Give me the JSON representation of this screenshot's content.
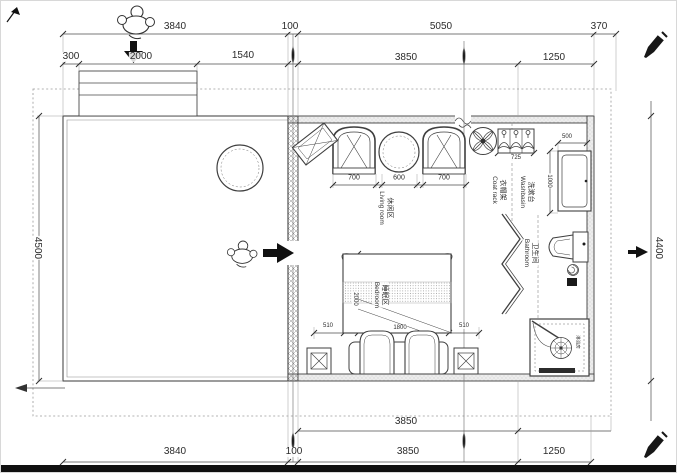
{
  "drawing_title": "guest-room-floor-plan",
  "colors": {
    "line": "#3f3f3f",
    "wall_fill": "#e6e6e6",
    "accent_black": "#111111"
  },
  "dims": {
    "t1_3840": "3840",
    "t1_100": "100",
    "t1_5050": "5050",
    "t1_370": "370",
    "t2_300": "300",
    "t2_2000": "2000",
    "t2_1540": "1540",
    "t2_3850": "3850",
    "t2_1250": "1250",
    "b1_3850": "3850",
    "b2_3840": "3840",
    "b2_100": "100",
    "b2_3850": "3850",
    "b2_1250": "1250",
    "left_4500": "4500",
    "right_4400": "4400",
    "chair_left": "700",
    "table": "600",
    "chair_right": "700",
    "coat_rack": "725",
    "washbasin_w": "500",
    "washbasin_d": "1000",
    "bed_left": "510",
    "bed_width": "1800",
    "bed_right": "510",
    "bed_length": "2000"
  },
  "rooms": {
    "living_zh": "休闲区",
    "living_en": "Living room",
    "bedroom_zh": "睡眠区",
    "bedroom_en": "Bedroom",
    "bathroom_zh": "卫生间",
    "bathroom_en": "Bathroom",
    "washbasin_zh": "洗漱台",
    "washbasin_en": "Washbasin",
    "coatrack_zh": "衣帽架",
    "coatrack_en": "Coat rack",
    "shower_zh": "淋浴房"
  }
}
